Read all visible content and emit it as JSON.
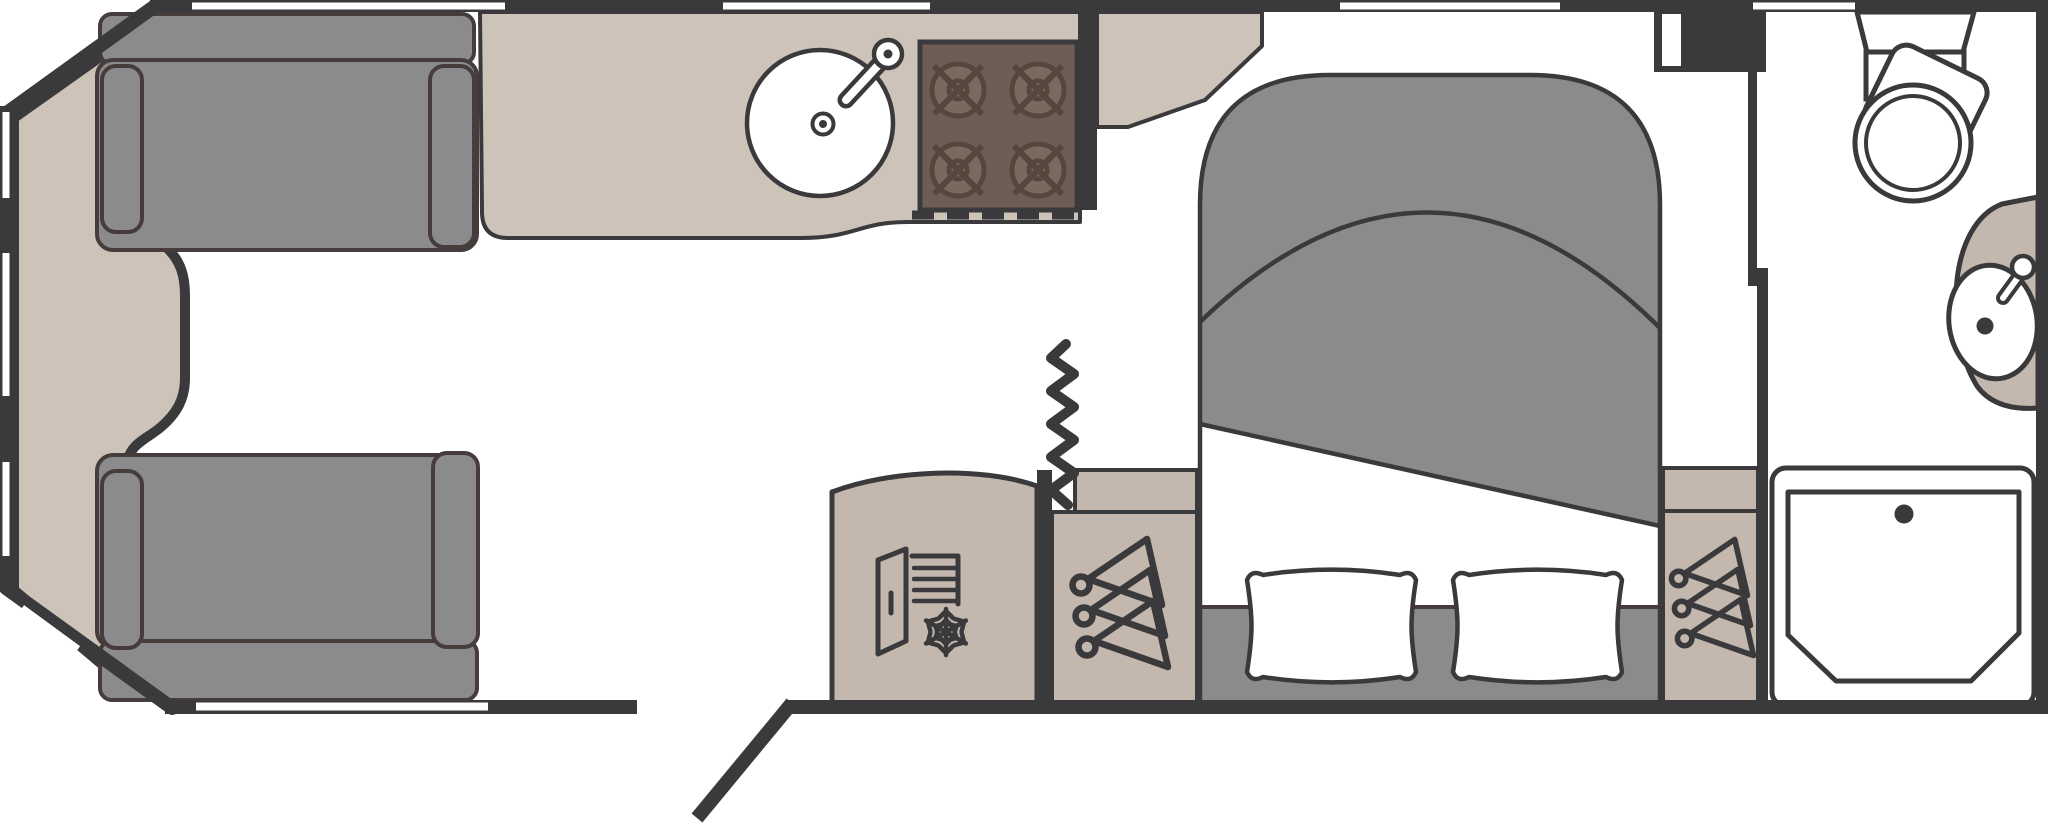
{
  "diagram": {
    "title": "Caravan floor plan (plan view)",
    "type": "caravan-floorplan",
    "description": "Top-down schematic of a single caravan layout: front lounge with two facing sofas, centre kitchen, island bed with wardrobes, rear end washroom, entrance door shown open"
  },
  "colors": {
    "wall": "#3a3a3c",
    "floor": "#ffffff",
    "upholstery_gray": "#8b8b8d",
    "worktop_beige": "#cdc3b9",
    "cabinet_beige": "#c4b8ae",
    "hob_brown": "#6e5d55",
    "hob_burner_brown": "#7a695f",
    "fixture_white": "#ffffff",
    "cushion_outline": "#473c3c"
  },
  "rooms": {
    "lounge": {
      "label": "Front lounge",
      "front_chest": "Front chest of drawers",
      "front_sofa": "Front sofa (nearside)",
      "rear_sofa": "Front sofa (offside)"
    },
    "kitchen": {
      "label": "Kitchen",
      "worktop": "Kitchen worktop",
      "sink": "Round sink with mixer tap",
      "hob": "Four-burner gas hob",
      "grill_vent": "Oven / grill vent (dashed)",
      "fridge": "Fridge freezer",
      "divider": "Kitchen end wall"
    },
    "bedroom": {
      "label": "Bedroom",
      "bed": "Island double bed with turned-back duvet",
      "pillow_left": "Pillow (left)",
      "pillow_right": "Pillow (right)",
      "wardrobe_left": "Bedside wardrobe with hangers (nearside)",
      "wardrobe_right": "Bedside wardrobe with hangers (offside)",
      "concertina_door": "Concertina / zig-zag partition door",
      "partition": "Bedroom-washroom partition wall"
    },
    "washroom": {
      "label": "End washroom",
      "door": "Washroom door (in frame)",
      "toilet": "Toilet with swivel bowl and cistern",
      "basin": "Corner wash basin with tap",
      "shower": "Shower tray with drain"
    },
    "entrance": {
      "label": "Entrance doorway with door shown open"
    }
  },
  "window_slits": {
    "top_wall": 4,
    "bottom_wall": 1,
    "front_left_wall": 4
  },
  "icon_names": [
    "sink-icon",
    "tap-icon",
    "burner-icon",
    "fridge-freezer-icon",
    "snowflake-icon",
    "hanger-icon",
    "concertina-door-icon",
    "toilet-icon",
    "basin-icon",
    "shower-tray-icon",
    "open-door-icon"
  ]
}
